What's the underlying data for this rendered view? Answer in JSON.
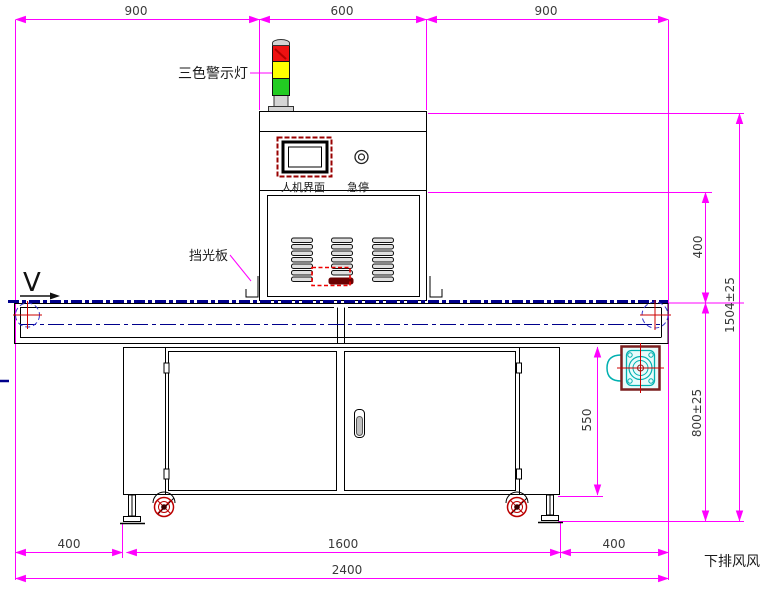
{
  "labels": {
    "warning_light": "三色警示灯",
    "hmi": "人机界面",
    "estop": "急停",
    "light_shield": "挡光板",
    "flow_direction": "V",
    "exhaust_note": "下排风风"
  },
  "dimensions": {
    "top_left": "900",
    "top_center": "600",
    "top_right": "900",
    "right_upper": "400",
    "right_total": "1504±25",
    "right_lower": "800±25",
    "cabinet_height": "550",
    "bottom_left": "400",
    "bottom_center": "1600",
    "bottom_right": "400",
    "bottom_total": "2400"
  },
  "colors": {
    "dimension": "#FF00FF",
    "outline": "#000000",
    "belt_line": "#00008B",
    "highlight": "#CC0000",
    "lamp_red": "#EE1111",
    "lamp_yellow": "#FFFF00",
    "lamp_green": "#22CC22",
    "motor_accent": "#00B0B0",
    "motor_frame": "#7A1F1F"
  }
}
